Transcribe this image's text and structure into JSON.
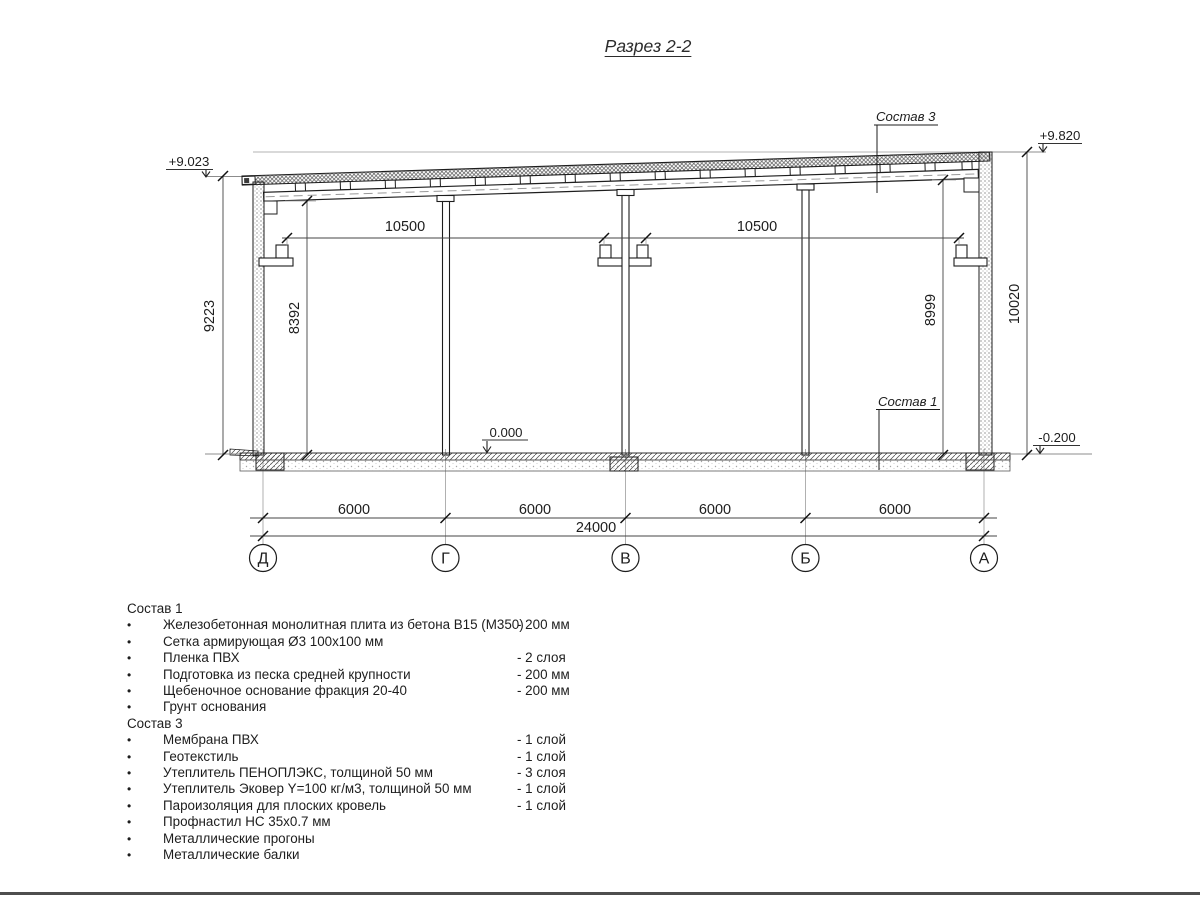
{
  "title": "Разрез 2-2",
  "drawing": {
    "elevations": {
      "top_left": "+9.023",
      "top_right": "+9.820",
      "floor": "0.000",
      "ground": "-0.200"
    },
    "callouts": {
      "roof": "Состав 3",
      "floor": "Состав 1"
    },
    "dims": {
      "span_left": "10500",
      "span_right": "10500",
      "h_left_outer": "9223",
      "h_left_inner": "8392",
      "h_right_inner": "8999",
      "h_right_outer": "10020",
      "bay": "6000",
      "total": "24000"
    },
    "axes": [
      "Д",
      "Г",
      "В",
      "Б",
      "А"
    ]
  },
  "lists": {
    "bullet": "•",
    "sostav1": {
      "title": "Состав 1",
      "items": [
        {
          "name": "Железобетонная монолитная плита из бетона В15 (М350)",
          "value": "-  200 мм"
        },
        {
          "name": "Сетка армирующая Ø3 100х100 мм",
          "value": ""
        },
        {
          "name": "Пленка ПВХ",
          "value": "-  2 слоя"
        },
        {
          "name": "Подготовка из песка средней крупности",
          "value": "- 200 мм"
        },
        {
          "name": "Щебеночное основание фракция 20-40",
          "value": "- 200 мм"
        },
        {
          "name": "Грунт основания",
          "value": ""
        }
      ]
    },
    "sostav3": {
      "title": "Состав 3",
      "items": [
        {
          "name": "Мембрана ПВХ",
          "value": "- 1 слой"
        },
        {
          "name": "Геотекстиль",
          "value": "- 1 слой"
        },
        {
          "name": "Утеплитель ПЕНОПЛЭКС, толщиной 50 мм",
          "value": "- 3 слоя"
        },
        {
          "name": "Утеплитель Эковер Y=100 кг/м3, толщиной 50 мм",
          "value": "- 1 слой"
        },
        {
          "name": "Пароизоляция для плоских кровель",
          "value": "- 1 слой"
        },
        {
          "name": "Профнастил НС 35х0.7 мм",
          "value": ""
        },
        {
          "name": "Металлические прогоны",
          "value": ""
        },
        {
          "name": "Металлические балки",
          "value": ""
        }
      ]
    }
  },
  "colors": {
    "line": "#1d1d1d",
    "thin_line": "#8c8c8c",
    "background": "#ffffff"
  }
}
